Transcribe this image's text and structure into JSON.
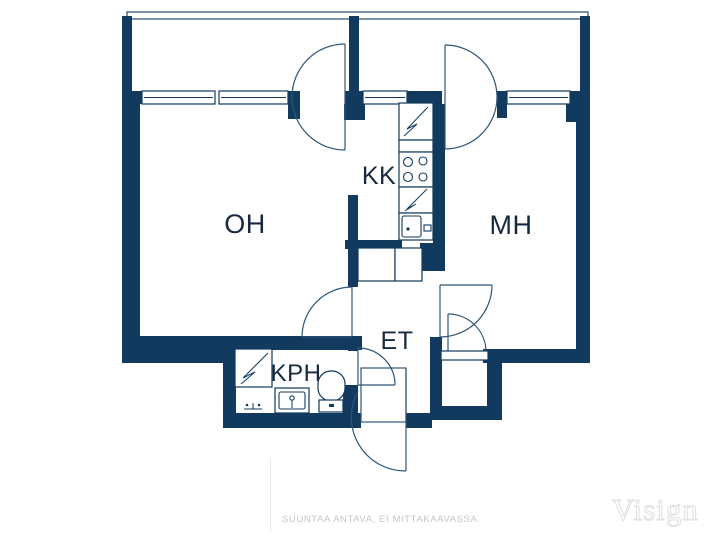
{
  "plan": {
    "rooms": {
      "oh": {
        "label": "OH"
      },
      "kk": {
        "label": "KK"
      },
      "mh": {
        "label": "MH"
      },
      "et": {
        "label": "ET"
      },
      "kph": {
        "label": "KPH"
      }
    },
    "icons": {
      "kitchen": [
        "fridge-icon",
        "counter-icon",
        "stove-icon",
        "cabinet-icon",
        "sink-icon"
      ],
      "bathroom": [
        "washing-machine-icon",
        "washbasin-icon",
        "toilet-icon",
        "shower-icon"
      ],
      "hallway": [
        "wardrobe-icon",
        "wardrobe-icon",
        "closet-door-icon"
      ]
    }
  },
  "footer": {
    "disclaimer": "SUUNTAA ANTAVA, EI MITTAKAAVASSA.",
    "brand": "Visign"
  },
  "colors": {
    "wall": "#123a5e",
    "line": "#2e5578",
    "text": "#16293d",
    "muted": "#c6c6c6",
    "logo_outline": "#dedede",
    "background": "#ffffff"
  }
}
